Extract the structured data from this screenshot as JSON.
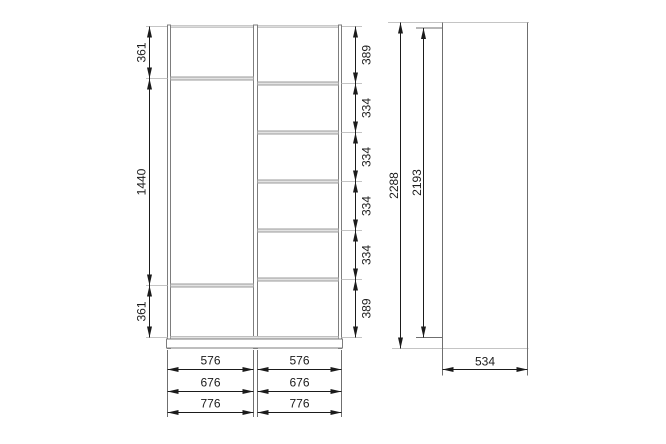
{
  "front_view": {
    "left_heights": [
      "361",
      "1440",
      "361"
    ],
    "right_heights": [
      "389",
      "334",
      "334",
      "334",
      "334",
      "389"
    ],
    "bottom_widths": {
      "row1": {
        "left": "576",
        "right": "576"
      },
      "row2": {
        "left": "676",
        "right": "676"
      },
      "row3": {
        "left": "776",
        "right": "776"
      }
    }
  },
  "side_view": {
    "total_height": "2288",
    "side_panel_height": "2193",
    "depth": "534"
  },
  "style": {
    "background": "#ffffff",
    "furniture_line_color": "#7d7d7d",
    "light_line_color": "#c4c4c4",
    "shelf_fill_color": "#e3e3e3",
    "dimension_color": "#1b1b1b"
  }
}
